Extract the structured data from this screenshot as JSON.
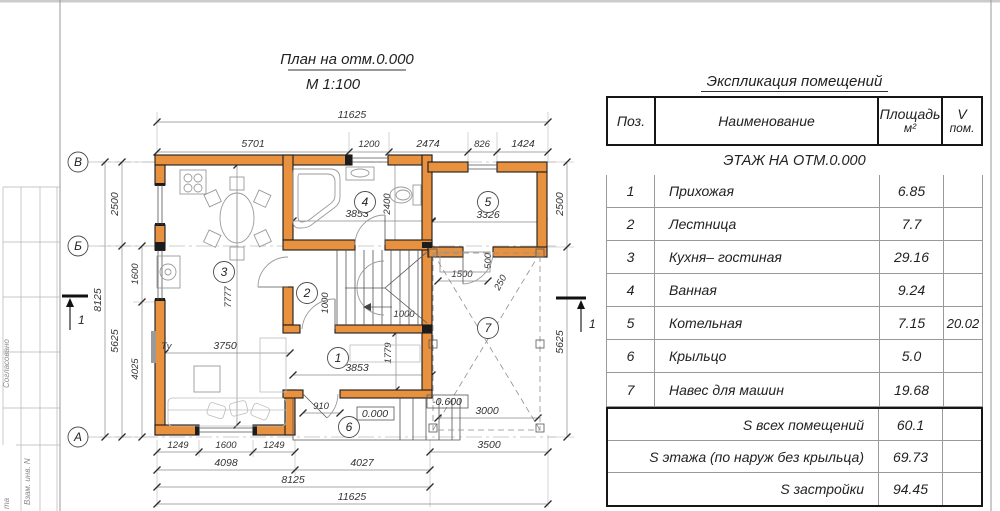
{
  "sheet": {
    "stamp": {
      "agreed": "Согласовано",
      "vzam": "Взам. инв. N",
      "ta": "та"
    }
  },
  "plan": {
    "title": "План на отм.0.000",
    "scale": "М 1:100",
    "axis_rows": [
      "В",
      "Б",
      "А"
    ],
    "section_mark": "1",
    "rooms": [
      "1",
      "2",
      "3",
      "4",
      "5",
      "6",
      "7"
    ],
    "tv_label": "Tv",
    "elev_zero": "0.000",
    "elev_minus": "-0.600",
    "dims": {
      "top_total": "11625",
      "t1": "5701",
      "t2": "1200",
      "t3": "2474",
      "t4": "826",
      "t5": "1424",
      "l_total": "8125",
      "l1": "2500",
      "l2": "5625",
      "l3": "1600",
      "l4": "4025",
      "r1": "2500",
      "r2": "5625",
      "b1": "1249",
      "b2": "1600",
      "b3": "3500",
      "b4": "4098",
      "b5": "4027",
      "b6": "8125",
      "b7": "11625",
      "bath_w": "3853",
      "bath_h": "2400",
      "boiler_w": "3326",
      "hall_w": "3853",
      "hall_h": "1779",
      "stair_a": "1000",
      "stair_b": "1000",
      "living_w": "3750",
      "living_h": "7777",
      "porch_door": "910",
      "car_w": "3000",
      "car_e1": "1500",
      "car_e2": "500",
      "car_e3": "250"
    }
  },
  "table": {
    "title": "Экспликация помещений",
    "columns": {
      "pos": "Поз.",
      "name": "Наименование",
      "area": "Площадь",
      "area_unit": "м²",
      "vol": "V",
      "vol_unit": "пом."
    },
    "section": "ЭТАЖ НА ОТМ.0.000",
    "rows": [
      {
        "pos": "1",
        "name": "Прихожая",
        "area": "6.85",
        "vol": ""
      },
      {
        "pos": "2",
        "name": "Лестница",
        "area": "7.7",
        "vol": ""
      },
      {
        "pos": "3",
        "name": "Кухня– гостиная",
        "area": "29.16",
        "vol": ""
      },
      {
        "pos": "4",
        "name": "Ванная",
        "area": "9.24",
        "vol": ""
      },
      {
        "pos": "5",
        "name": "Котельная",
        "area": "7.15",
        "vol": "20.02"
      },
      {
        "pos": "6",
        "name": "Крыльцо",
        "area": "5.0",
        "vol": ""
      },
      {
        "pos": "7",
        "name": "Навес для машин",
        "area": "19.68",
        "vol": ""
      }
    ],
    "summary": [
      {
        "name": "S всех помещений",
        "area": "60.1"
      },
      {
        "name": "S этажа (по наруж без крыльца)",
        "area": "69.73"
      },
      {
        "name": "S застройки",
        "area": "94.45"
      }
    ]
  }
}
